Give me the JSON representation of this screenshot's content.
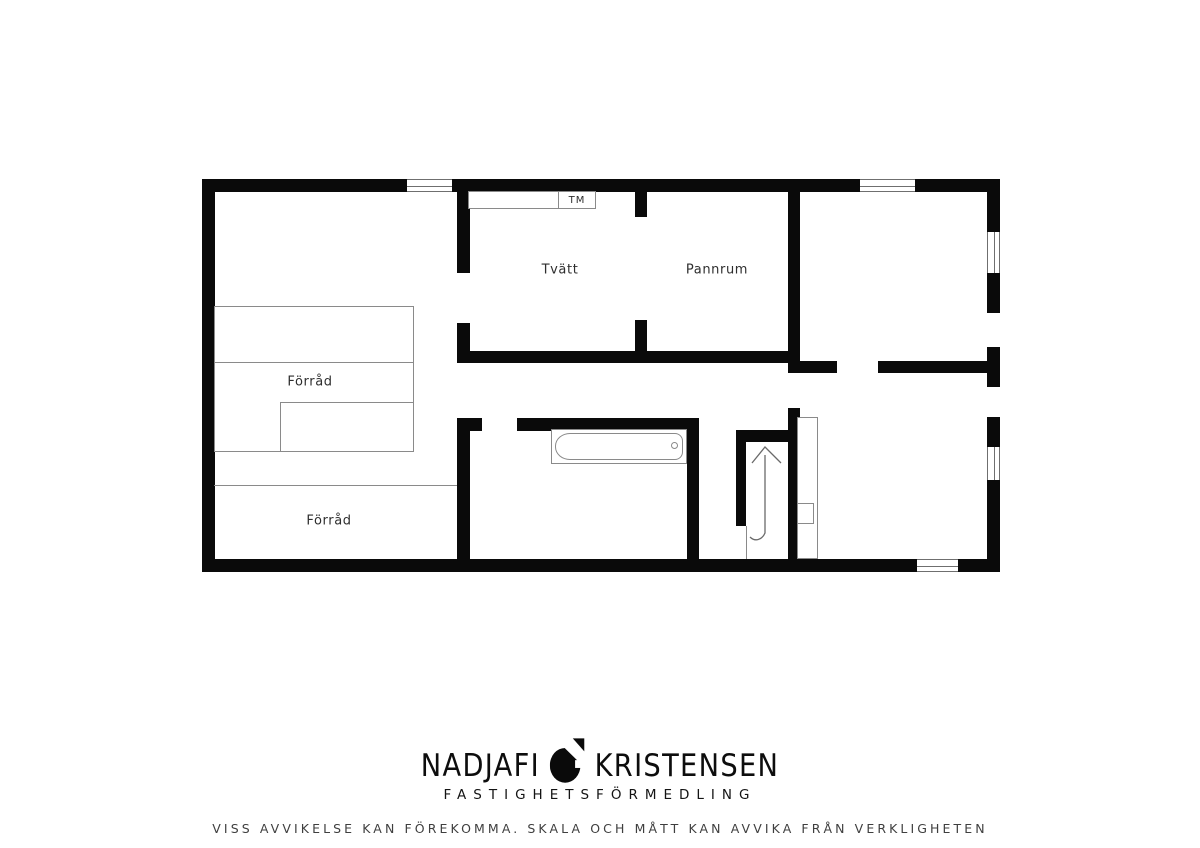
{
  "plan": {
    "rooms": [
      {
        "id": "tvatt",
        "label": "Tvätt"
      },
      {
        "id": "pannrum",
        "label": "Pannrum"
      },
      {
        "id": "forrad-upper",
        "label": "Förråd"
      },
      {
        "id": "forrad-lower",
        "label": "Förråd"
      }
    ],
    "appliances": [
      {
        "id": "washing-machine",
        "label": "TM"
      }
    ],
    "colors": {
      "wall": "#0a0a0a",
      "furniture_line": "#8a8a8a",
      "label_text": "#2e2e2e"
    }
  },
  "footer": {
    "brand_first": "NADJAFI",
    "brand_second": "KRISTENSEN",
    "tagline": "FASTIGHETSFÖRMEDLING",
    "disclaimer": "VISS AVVIKELSE KAN FÖREKOMMA. SKALA OCH MÅTT KAN AVVIKA FRÅN VERKLIGHETEN"
  }
}
